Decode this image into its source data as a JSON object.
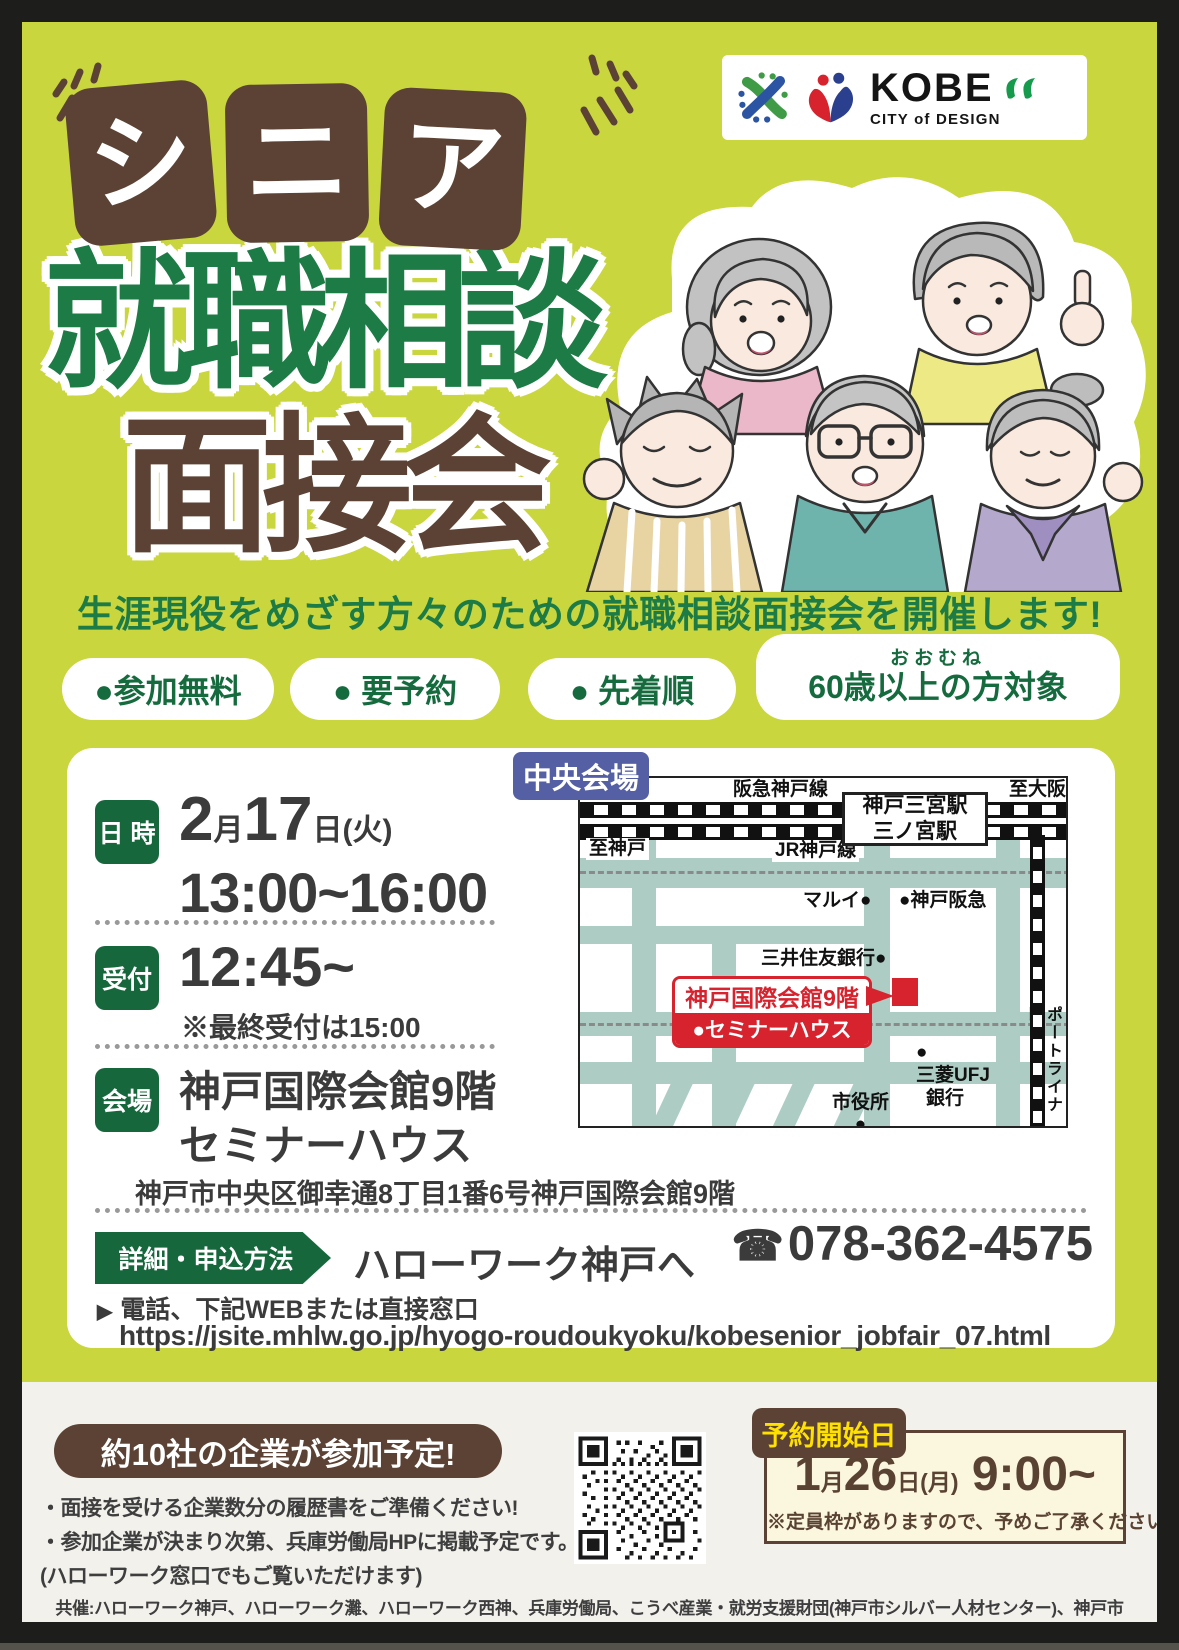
{
  "logo": {
    "kobe": "KOBE",
    "subtitle": "CITY of DESIGN"
  },
  "title": {
    "chars": [
      "シ",
      "ニ",
      "ア"
    ],
    "line1": "就職相談",
    "line2": "面接会"
  },
  "headline": "生涯現役をめざす方々のための就職相談面接会を開催します!",
  "pills": {
    "p1": "●参加無料",
    "p2": "● 要予約",
    "p3": "● 先着順",
    "p4_ruby": "おおむね",
    "p4": "60歳以上の方対象"
  },
  "schedule": {
    "datetime_label": "日 時",
    "date_m_num": "2",
    "date_m": "月",
    "date_d_num": "17",
    "date_d": "日",
    "date_w": "(火)",
    "time": "13:00~16:00",
    "reception_label": "受付",
    "reception_time": "12:45~",
    "reception_note": "※最終受付は15:00",
    "venue_label": "会場",
    "venue_line1": "神戸国際会館9階",
    "venue_line2": "セミナーハウス",
    "venue_address": "神戸市中央区御幸通8丁目1番6号神戸国際会館9階"
  },
  "apply": {
    "label": "詳細・申込方法",
    "target": "ハローワーク神戸へ",
    "phone_icon": "☎",
    "phone": "078-362-4575",
    "mark": "▶",
    "note": "電話、下記WEBまたは直接窓口",
    "url": "https://jsite.mhlw.go.jp/hyogo-roudoukyoku/kobesenior_jobfair_07.html"
  },
  "map": {
    "badge": "中央会場",
    "hankyu_line": "阪急神戸線",
    "to_osaka": "至大阪",
    "station1": "神戸三宮駅",
    "station2": "三ノ宮駅",
    "to_kobe": "至神戸",
    "jr_line": "JR神戸線",
    "marui": "マルイ●",
    "kobe_hankyu": "●神戸阪急",
    "smbc": "三井住友銀行●",
    "venue1": "神戸国際会館9階",
    "venue2": "●セミナーハウス",
    "mufg_dot": "●",
    "mufg1": "三菱UFJ",
    "mufg2": "銀行",
    "city_hall": "市役所",
    "city_hall_dot": "●",
    "port_liner": "ポートライナー"
  },
  "bottom": {
    "companies": "約10社の企業が参加予定!",
    "b1": "・面接を受ける企業数分の履歴書をご準備ください!",
    "b2": "・参加企業が決まり次第、兵庫労働局HPに掲載予定です。",
    "b3": "(ハローワーク窓口でもご覧いただけます)",
    "reserve_label": "予約開始日",
    "rsv_m_num": "1",
    "rsv_m": "月",
    "rsv_d_num": "26",
    "rsv_d": "日(月)",
    "rsv_time": " 9:00~",
    "reserve_note": "※定員枠がありますので、予めご了承ください。",
    "organizers": "共催:ハローワーク神戸、ハローワーク灘、ハローワーク西神、兵庫労働局、こうべ産業・就労支援財団(神戸市シルバー人材センター)、神戸市"
  },
  "colors": {
    "bg_green": "#c9d63e",
    "brown": "#5b4234",
    "title_green": "#1d7b46",
    "tag_green": "#17673d",
    "map_badge_blue": "#5560a4",
    "red": "#d7232e",
    "yellow_text": "#ffe100",
    "cream": "#f3f1ec",
    "road": "#adcdc4"
  }
}
